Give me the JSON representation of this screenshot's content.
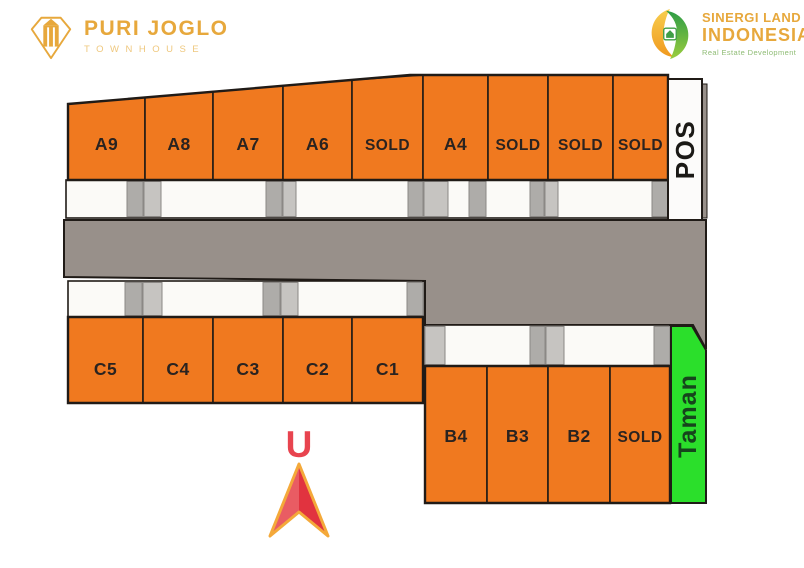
{
  "branding": {
    "left_logo": {
      "title": "PURI JOGLO",
      "subtitle": "TOWNHOUSE",
      "gold": "#E7A83C"
    },
    "right_logo": {
      "name_line1": "SINERGI LAND",
      "name_line2": "INDONESIA",
      "tagline": "Real Estate Development",
      "gold": "#E7A83C",
      "green": "#3F9E46"
    }
  },
  "compass": {
    "label": "U",
    "label_color": "#E8444F",
    "cx": 299,
    "label_baseline_y": 457,
    "arrow": {
      "tip_y": 464,
      "base_y": 536,
      "notch_y": 512,
      "half_width": 29,
      "left_fill": "#E95C63",
      "right_fill": "#E1333F",
      "outline": "#F4A93A"
    }
  },
  "site_plan": {
    "colors": {
      "unit": "#F0791F",
      "road": "#98908A",
      "yard": "#FBFAF7",
      "pad_light": "#C6C4C1",
      "pad_dark": "#AEACA9",
      "pos_bg": "#FCFBFA",
      "taman": "#2BDF2B",
      "outline": "#201B17",
      "label": "#2A2320",
      "taman_label": "#16441C",
      "pos_label": "#1B1916"
    },
    "road": {
      "points": "64,220 706,220 706,349 693,325 425,325 425,281 64,277"
    },
    "edge_strip": {
      "x": 702,
      "y": 84,
      "w": 5,
      "h": 134
    },
    "strips": [
      {
        "name": "row-a-frontage",
        "x": 66,
        "y": 180,
        "w": 602,
        "h": 38,
        "pads": [
          [
            127,
            16,
            "d"
          ],
          [
            144,
            17,
            "l"
          ],
          [
            266,
            16,
            "d"
          ],
          [
            283,
            13,
            "l"
          ],
          [
            408,
            15,
            "d"
          ],
          [
            424,
            24,
            "l"
          ],
          [
            469,
            17,
            "d"
          ],
          [
            530,
            14,
            "d"
          ],
          [
            545,
            13,
            "l"
          ],
          [
            652,
            16,
            "d"
          ]
        ]
      },
      {
        "name": "row-c-frontage",
        "x": 68,
        "y": 281,
        "w": 355,
        "h": 36,
        "pads": [
          [
            125,
            17,
            "d"
          ],
          [
            143,
            19,
            "l"
          ],
          [
            263,
            17,
            "d"
          ],
          [
            281,
            17,
            "l"
          ],
          [
            407,
            16,
            "d"
          ]
        ]
      },
      {
        "name": "row-b-frontage",
        "x": 425,
        "y": 325,
        "w": 245,
        "h": 41,
        "pads": [
          [
            425,
            20,
            "l"
          ],
          [
            530,
            15,
            "d"
          ],
          [
            546,
            18,
            "l"
          ],
          [
            654,
            16,
            "d"
          ]
        ]
      }
    ],
    "rows": [
      {
        "name": "row-a",
        "outline": "68,104 410,75 668,75 668,180 68,180",
        "slant": {
          "x0": 68,
          "y0": 104,
          "x1": 410,
          "y1": 75
        },
        "bottom": 180,
        "label_baseline_y": 150,
        "xs": [
          68,
          145,
          213,
          283,
          352,
          423,
          488,
          548,
          613,
          668
        ],
        "units": [
          {
            "label": "A9",
            "status": "available"
          },
          {
            "label": "A8",
            "status": "available"
          },
          {
            "label": "A7",
            "status": "available"
          },
          {
            "label": "A6",
            "status": "available"
          },
          {
            "label": "SOLD",
            "status": "sold"
          },
          {
            "label": "A4",
            "status": "available"
          },
          {
            "label": "SOLD",
            "status": "sold"
          },
          {
            "label": "SOLD",
            "status": "sold"
          },
          {
            "label": "SOLD",
            "status": "sold"
          }
        ]
      },
      {
        "name": "row-c",
        "outline": "68,317 423,317 423,403 68,403",
        "top": 317,
        "bottom": 403,
        "label_baseline_y": 375,
        "xs": [
          68,
          143,
          213,
          283,
          352,
          423
        ],
        "units": [
          {
            "label": "C5",
            "status": "available"
          },
          {
            "label": "C4",
            "status": "available"
          },
          {
            "label": "C3",
            "status": "available"
          },
          {
            "label": "C2",
            "status": "available"
          },
          {
            "label": "C1",
            "status": "available"
          }
        ]
      },
      {
        "name": "row-b",
        "outline": "425,366 670,366 670,503 425,503",
        "top": 366,
        "bottom": 503,
        "label_baseline_y": 442,
        "xs": [
          425,
          487,
          548,
          610,
          670
        ],
        "units": [
          {
            "label": "B4",
            "status": "available"
          },
          {
            "label": "B3",
            "status": "available"
          },
          {
            "label": "B2",
            "status": "available"
          },
          {
            "label": "SOLD",
            "status": "sold"
          }
        ]
      }
    ],
    "pos": {
      "label": "POS",
      "x": 668,
      "y": 79,
      "w": 34,
      "h": 141
    },
    "taman": {
      "label": "Taman",
      "points": "671,326 692,326 706,350 706,503 671,503",
      "label_cx": 688,
      "label_cy": 416
    }
  }
}
